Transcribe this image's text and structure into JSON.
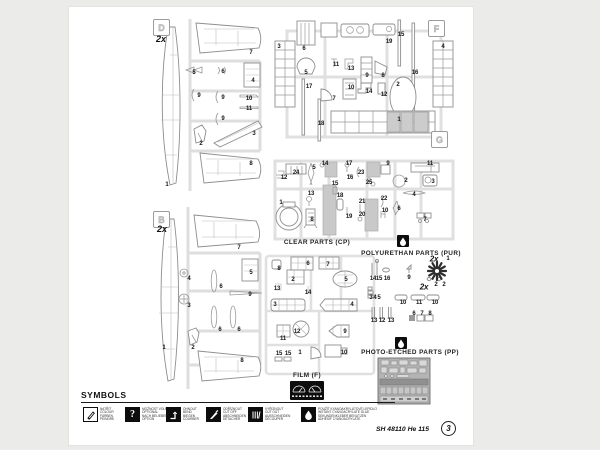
{
  "sheet": {
    "footer_code": "SH 48110 He 115",
    "sheet_number": "3"
  },
  "sections": {
    "clear_parts": "CLEAR PARTS (CP)",
    "polyurethan": "POLYURETHAN  PARTS  (PUR)",
    "photo_etched": "PHOTO-ETCHED PARTS  (PP)",
    "film": "FILM (F)",
    "symbols": "SYMBOLS"
  },
  "sprues": {
    "d": {
      "badge": "D",
      "multiplier": "2x"
    },
    "f": {
      "badge": "F"
    },
    "g": {
      "badge": "G"
    },
    "b": {
      "badge": "B",
      "multiplier": "2x"
    }
  },
  "part_groups": {
    "sprue_d": [
      {
        "t": "1",
        "x": 98,
        "y": 178
      },
      {
        "t": "7",
        "x": 182,
        "y": 46
      },
      {
        "t": "5",
        "x": 125,
        "y": 66
      },
      {
        "t": "6",
        "x": 154,
        "y": 65
      },
      {
        "t": "4",
        "x": 184,
        "y": 74
      },
      {
        "t": "9",
        "x": 130,
        "y": 89
      },
      {
        "t": "9",
        "x": 154,
        "y": 91
      },
      {
        "t": "10",
        "x": 180,
        "y": 92
      },
      {
        "t": "11",
        "x": 180,
        "y": 102
      },
      {
        "t": "9",
        "x": 154,
        "y": 112
      },
      {
        "t": "2",
        "x": 132,
        "y": 137
      },
      {
        "t": "3",
        "x": 185,
        "y": 127
      },
      {
        "t": "8",
        "x": 182,
        "y": 157
      }
    ],
    "sprue_f": [
      {
        "t": "3",
        "x": 210,
        "y": 40
      },
      {
        "t": "6",
        "x": 235,
        "y": 42
      },
      {
        "t": "19",
        "x": 320,
        "y": 35
      },
      {
        "t": "15",
        "x": 332,
        "y": 28
      },
      {
        "t": "4",
        "x": 374,
        "y": 40
      },
      {
        "t": "5",
        "x": 237,
        "y": 66
      },
      {
        "t": "11",
        "x": 267,
        "y": 58
      },
      {
        "t": "13",
        "x": 282,
        "y": 62
      },
      {
        "t": "9",
        "x": 298,
        "y": 69
      },
      {
        "t": "8",
        "x": 314,
        "y": 69
      },
      {
        "t": "16",
        "x": 346,
        "y": 66
      },
      {
        "t": "17",
        "x": 240,
        "y": 80
      },
      {
        "t": "10",
        "x": 282,
        "y": 81
      },
      {
        "t": "14",
        "x": 300,
        "y": 85
      },
      {
        "t": "12",
        "x": 315,
        "y": 88
      },
      {
        "t": "2",
        "x": 329,
        "y": 78
      },
      {
        "t": "7",
        "x": 265,
        "y": 92
      },
      {
        "t": "18",
        "x": 252,
        "y": 117
      },
      {
        "t": "1",
        "x": 330,
        "y": 113
      }
    ],
    "sprue_g": [
      {
        "t": "24",
        "x": 227,
        "y": 166
      },
      {
        "t": "12",
        "x": 215,
        "y": 171
      },
      {
        "t": "5",
        "x": 245,
        "y": 161
      },
      {
        "t": "14",
        "x": 256,
        "y": 157
      },
      {
        "t": "17",
        "x": 280,
        "y": 157
      },
      {
        "t": "16",
        "x": 281,
        "y": 171
      },
      {
        "t": "23",
        "x": 292,
        "y": 166
      },
      {
        "t": "25",
        "x": 300,
        "y": 176
      },
      {
        "t": "9",
        "x": 319,
        "y": 157
      },
      {
        "t": "11",
        "x": 361,
        "y": 157
      },
      {
        "t": "2",
        "x": 337,
        "y": 174
      },
      {
        "t": "3",
        "x": 364,
        "y": 175
      },
      {
        "t": "13",
        "x": 242,
        "y": 187
      },
      {
        "t": "8",
        "x": 243,
        "y": 213
      },
      {
        "t": "15",
        "x": 266,
        "y": 177
      },
      {
        "t": "18",
        "x": 271,
        "y": 189
      },
      {
        "t": "19",
        "x": 280,
        "y": 210
      },
      {
        "t": "20",
        "x": 293,
        "y": 208
      },
      {
        "t": "21",
        "x": 293,
        "y": 195
      },
      {
        "t": "22",
        "x": 315,
        "y": 192
      },
      {
        "t": "10",
        "x": 316,
        "y": 204
      },
      {
        "t": "4",
        "x": 345,
        "y": 188
      },
      {
        "t": "6",
        "x": 330,
        "y": 202
      },
      {
        "t": "7",
        "x": 356,
        "y": 213
      },
      {
        "t": "1",
        "x": 212,
        "y": 196
      }
    ],
    "sprue_b": [
      {
        "t": "7",
        "x": 170,
        "y": 241
      },
      {
        "t": "4",
        "x": 120,
        "y": 272
      },
      {
        "t": "5",
        "x": 182,
        "y": 266
      },
      {
        "t": "6",
        "x": 152,
        "y": 280
      },
      {
        "t": "9",
        "x": 181,
        "y": 288
      },
      {
        "t": "3",
        "x": 120,
        "y": 299
      },
      {
        "t": "6",
        "x": 151,
        "y": 323
      },
      {
        "t": "6",
        "x": 170,
        "y": 323
      },
      {
        "t": "2",
        "x": 124,
        "y": 341
      },
      {
        "t": "1",
        "x": 95,
        "y": 341
      },
      {
        "t": "8",
        "x": 173,
        "y": 354
      }
    ],
    "clear_parts": [
      {
        "t": "8",
        "x": 210,
        "y": 262
      },
      {
        "t": "6",
        "x": 239,
        "y": 257
      },
      {
        "t": "7",
        "x": 259,
        "y": 258
      },
      {
        "t": "2",
        "x": 224,
        "y": 273
      },
      {
        "t": "5",
        "x": 277,
        "y": 273
      },
      {
        "t": "13",
        "x": 208,
        "y": 282
      },
      {
        "t": "14",
        "x": 239,
        "y": 286
      },
      {
        "t": "3",
        "x": 206,
        "y": 298
      },
      {
        "t": "4",
        "x": 283,
        "y": 298
      },
      {
        "t": "11",
        "x": 214,
        "y": 332
      },
      {
        "t": "12",
        "x": 228,
        "y": 325
      },
      {
        "t": "9",
        "x": 276,
        "y": 325
      },
      {
        "t": "15",
        "x": 210,
        "y": 347
      },
      {
        "t": "15",
        "x": 219,
        "y": 347
      },
      {
        "t": "1",
        "x": 231,
        "y": 346
      },
      {
        "t": "10",
        "x": 275,
        "y": 346
      }
    ],
    "polyurethan": [
      {
        "t": "14",
        "x": 304,
        "y": 272
      },
      {
        "t": "15",
        "x": 310,
        "y": 272
      },
      {
        "t": "16",
        "x": 318,
        "y": 272
      },
      {
        "t": "9",
        "x": 340,
        "y": 271
      },
      {
        "t": "2x",
        "x": 365,
        "y": 252,
        "big": true
      },
      {
        "t": "1",
        "x": 379,
        "y": 252
      },
      {
        "t": "2x",
        "x": 355,
        "y": 280,
        "big": true
      },
      {
        "t": "2",
        "x": 367,
        "y": 278
      },
      {
        "t": "2",
        "x": 375,
        "y": 278
      },
      {
        "t": "3",
        "x": 302,
        "y": 291
      },
      {
        "t": "4",
        "x": 306,
        "y": 291
      },
      {
        "t": "5",
        "x": 310,
        "y": 291
      },
      {
        "t": "10",
        "x": 334,
        "y": 296
      },
      {
        "t": "11",
        "x": 350,
        "y": 296
      },
      {
        "t": "10",
        "x": 366,
        "y": 296
      },
      {
        "t": "13",
        "x": 305,
        "y": 314
      },
      {
        "t": "12",
        "x": 313,
        "y": 314
      },
      {
        "t": "13",
        "x": 322,
        "y": 314
      },
      {
        "t": "6",
        "x": 345,
        "y": 307
      },
      {
        "t": "7",
        "x": 353,
        "y": 307
      },
      {
        "t": "8",
        "x": 361,
        "y": 307
      }
    ]
  },
  "symbols": {
    "items": [
      {
        "icon": "paint-brush",
        "l1": "NATŘÍT",
        "l2": "COLOUR",
        "l3": "FÄRBEN",
        "l4": "PEINDRE"
      },
      {
        "icon": "question-mark",
        "l1": "MOŽNOST VOLBY",
        "l2": "OPTIONAL",
        "l3": "NACH BELIEBEN",
        "l4": "OPTION"
      },
      {
        "icon": "bend",
        "l1": "OHNOUT",
        "l2": "BEND",
        "l3": "BIEGEN",
        "l4": "COURBER"
      },
      {
        "icon": "cut-off",
        "l1": "ODŘÍZNOUT",
        "l2": "CUT OFF",
        "l3": "ABSCHNEIDEN",
        "l4": "DÉTACHER"
      },
      {
        "icon": "cut-out",
        "l1": "VYŘÍZNOUT",
        "l2": "CUT OUT",
        "l3": "AUSSCHNEIDEN",
        "l4": "DÉCOUPER"
      },
      {
        "icon": "glue-drop",
        "l1": "POUŽÍT KYANOAKRYLÁTOVÉ LEPIDLO",
        "l2": "INSTANT CYANOACRYLATE GLUE",
        "l3": "SEKUNDENKLEBER BENUTZEN",
        "l4": "ADHÉSIF CYANOACRYLATE"
      }
    ]
  }
}
